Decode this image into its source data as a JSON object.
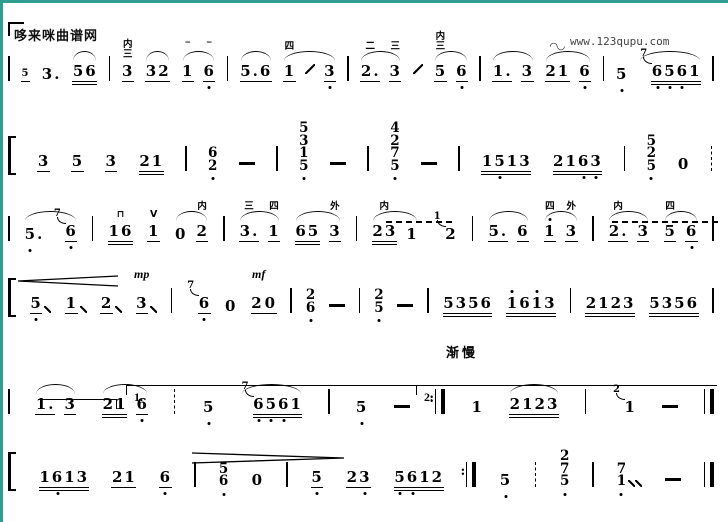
{
  "page": {
    "watermark": "哆来咪曲谱网",
    "site_url": "www.123qupu.com",
    "tempo_mark": "渐慢",
    "accent_color": "#2f9e92",
    "ink_color": "#000000"
  },
  "score": {
    "lines": [
      {
        "top": 30,
        "tokens": [
          {
            "t": "b",
            "v": "thin"
          },
          {
            "d": "5",
            "tiny": true,
            "u": 1
          },
          {
            "d": "3."
          },
          {
            "d": "56",
            "u": 2,
            "s": 1
          },
          {
            "t": "b",
            "v": "thin"
          },
          {
            "d": "3",
            "u": 1,
            "a": [
              "内",
              "三"
            ]
          },
          {
            "d": "32",
            "u": 1,
            "s": 1
          },
          {
            "t": "g",
            "s": 1,
            "n": [
              {
                "d": "1",
                "u": 1,
                "a": [
                  "‾"
                ]
              },
              {
                "d": "6",
                "u": 1,
                "lo": [
                  0
                ],
                "a": [
                  "‾"
                ]
              }
            ]
          },
          {
            "t": "b",
            "v": "thin"
          },
          {
            "d": "5.6",
            "u": 1,
            "s": 1
          },
          {
            "t": "g",
            "s": 1,
            "n": [
              {
                "d": "1",
                "u": 1,
                "a": [
                  "四"
                ]
              },
              {
                "t": "sl"
              },
              {
                "d": "3",
                "u": 1,
                "lo": [
                  0
                ]
              }
            ]
          },
          {
            "t": "b",
            "v": "thin"
          },
          {
            "t": "g",
            "s": 1,
            "n": [
              {
                "d": "2.",
                "u": 1,
                "a": [
                  "二"
                ]
              },
              {
                "d": "3",
                "u": 1,
                "a": [
                  "三"
                ]
              }
            ]
          },
          {
            "t": "sl"
          },
          {
            "t": "g",
            "s": 1,
            "n": [
              {
                "d": "5",
                "u": 1,
                "a": [
                  "内",
                  "三"
                ]
              },
              {
                "d": "6",
                "u": 1,
                "lo": [
                  0
                ]
              }
            ]
          },
          {
            "t": "b",
            "v": "thin"
          },
          {
            "t": "g",
            "s": 1,
            "n": [
              {
                "d": "1.",
                "u": 1
              },
              {
                "d": "3",
                "u": 1
              }
            ]
          },
          {
            "t": "g",
            "s": 1,
            "n": [
              {
                "d": "21",
                "u": 1,
                "a": [
                  "◠◡"
                ]
              },
              {
                "d": "6",
                "u": 1,
                "lo": [
                  0
                ]
              }
            ]
          },
          {
            "t": "b",
            "v": "thin"
          },
          {
            "d": "5",
            "lo": [
              0
            ]
          },
          {
            "d": "6561",
            "u": 2,
            "s": 1,
            "g": "7",
            "lo": [
              0,
              1,
              2
            ]
          },
          {
            "t": "b",
            "v": "thin"
          }
        ],
        "ex": []
      },
      {
        "top": 96,
        "tokens": [
          {
            "t": "b",
            "v": "brk"
          },
          {
            "d": "3",
            "u": 1
          },
          {
            "d": "5",
            "u": 1
          },
          {
            "d": "3",
            "u": 1
          },
          {
            "d": "21",
            "u": 2
          },
          {
            "t": "b",
            "v": "thin"
          },
          {
            "t": "c",
            "d": [
              "6",
              "2"
            ],
            "lo": true
          },
          {
            "t": "-"
          },
          {
            "t": "b",
            "v": "thin"
          },
          {
            "t": "c",
            "d": [
              "5",
              "3",
              "1",
              "5"
            ],
            "lo": true
          },
          {
            "t": "-"
          },
          {
            "t": "b",
            "v": "thin"
          },
          {
            "t": "c",
            "d": [
              "4",
              "2",
              "7",
              "5"
            ],
            "lo": true
          },
          {
            "t": "-"
          },
          {
            "t": "b",
            "v": "thin"
          },
          {
            "d": "1513",
            "u": 2,
            "lo": [
              1
            ]
          },
          {
            "d": "2163",
            "u": 2,
            "lo": [
              2,
              3
            ]
          },
          {
            "t": "b",
            "v": "thin"
          },
          {
            "t": "c",
            "d": [
              "5",
              "2",
              "5"
            ],
            "lo": true
          },
          {
            "d": "0"
          },
          {
            "t": "b",
            "v": "dash"
          }
        ],
        "ex": []
      },
      {
        "top": 190,
        "tokens": [
          {
            "t": "b",
            "v": "thin"
          },
          {
            "t": "g",
            "s": 1,
            "n": [
              {
                "d": "5.",
                "lo": [
                  0
                ]
              },
              {
                "d": "6",
                "u": 1,
                "lo": [
                  0
                ],
                "g": "7"
              }
            ]
          },
          {
            "t": "b",
            "v": "thin"
          },
          {
            "d": "16",
            "u": 2,
            "a": [
              "⊓"
            ]
          },
          {
            "d": "1",
            "u": 1,
            "a": [
              "V"
            ]
          },
          {
            "t": "g",
            "s": 1,
            "n": [
              {
                "d": "0"
              },
              {
                "d": "2",
                "u": 1,
                "a": [
                  "内"
                ]
              }
            ]
          },
          {
            "t": "b",
            "v": "thin"
          },
          {
            "t": "g",
            "s": 1,
            "n": [
              {
                "d": "3.",
                "u": 1,
                "a": [
                  "三"
                ]
              },
              {
                "d": "1",
                "u": 1,
                "a": [
                  "四"
                ]
              }
            ]
          },
          {
            "t": "g",
            "s": 1,
            "n": [
              {
                "d": "65",
                "u": 2
              },
              {
                "d": "3",
                "u": 1,
                "a": [
                  "外"
                ]
              }
            ]
          },
          {
            "t": "b",
            "v": "thin"
          },
          {
            "t": "g",
            "s": 1,
            "n": [
              {
                "d": "23",
                "u": 2,
                "a": [
                  "内"
                ]
              },
              {
                "d": "1"
              }
            ]
          },
          {
            "d": "2",
            "g": "1"
          },
          {
            "t": "b",
            "v": "thin"
          },
          {
            "t": "g",
            "s": 1,
            "n": [
              {
                "d": "5.",
                "u": 1
              },
              {
                "d": "6",
                "u": 1
              }
            ]
          },
          {
            "t": "g",
            "s": 1,
            "n": [
              {
                "d": "1",
                "u": 1,
                "hi": [
                  0
                ],
                "a": [
                  "四"
                ]
              },
              {
                "d": "3",
                "u": 1,
                "a": [
                  "外"
                ]
              }
            ]
          },
          {
            "t": "b",
            "v": "thin"
          },
          {
            "t": "g",
            "s": 1,
            "n": [
              {
                "d": "2.",
                "u": 1,
                "a": [
                  "内"
                ]
              },
              {
                "d": "3",
                "u": 1
              }
            ]
          },
          {
            "t": "g",
            "s": 1,
            "n": [
              {
                "d": "5",
                "u": 1,
                "a": [
                  "四"
                ]
              },
              {
                "d": "6",
                "u": 1,
                "lo": [
                  0
                ]
              }
            ]
          },
          {
            "t": "b",
            "v": "thin"
          }
        ],
        "ex": [
          {
            "t": "hairpin",
            "dir": "<",
            "x": 10,
            "w": 100,
            "y": 56
          },
          {
            "t": "dyn",
            "d": "mp",
            "x": 126,
            "y": 51
          },
          {
            "t": "dyn",
            "d": "mf",
            "x": 244,
            "y": 51
          },
          {
            "t": "dashline",
            "x": 378,
            "w": 66,
            "y": 5
          },
          {
            "t": "dashline",
            "x": 604,
            "w": 106,
            "y": 5
          }
        ]
      },
      {
        "top": 252,
        "tokens": [
          {
            "t": "b",
            "v": "brk"
          },
          {
            "d": "5",
            "u": 1,
            "lo": [
              0
            ],
            "post": "/"
          },
          {
            "d": "1",
            "u": 1,
            "post": "/"
          },
          {
            "d": "2",
            "u": 1,
            "post": "/"
          },
          {
            "d": "3",
            "u": 1,
            "post": "/"
          },
          {
            "t": "b",
            "v": "thin"
          },
          {
            "d": "6",
            "u": 1,
            "lo": [
              0
            ],
            "g": "7"
          },
          {
            "d": "0"
          },
          {
            "d": "2 0",
            "u": 1
          },
          {
            "t": "b",
            "v": "thin"
          },
          {
            "t": "c",
            "d": [
              "2",
              "6"
            ],
            "lo": true
          },
          {
            "t": "-"
          },
          {
            "t": "b",
            "v": "thin"
          },
          {
            "t": "c",
            "d": [
              "2",
              "5"
            ],
            "lo": true
          },
          {
            "t": "-"
          },
          {
            "t": "b",
            "v": "thin"
          },
          {
            "d": "5356",
            "u": 2
          },
          {
            "d": "1613",
            "u": 2,
            "hi": [
              0,
              2
            ]
          },
          {
            "t": "b",
            "v": "thin"
          },
          {
            "d": "2123",
            "u": 2
          },
          {
            "d": "5356",
            "u": 2
          },
          {
            "t": "b",
            "v": "thin"
          }
        ],
        "ex": []
      },
      {
        "top": 363,
        "tokens": [
          {
            "t": "b",
            "v": "thin"
          },
          {
            "t": "g",
            "s": 1,
            "n": [
              {
                "d": "1.",
                "u": 1
              },
              {
                "d": "3",
                "u": 1
              }
            ]
          },
          {
            "t": "g",
            "s": 1,
            "n": [
              {
                "d": "21",
                "u": 2
              },
              {
                "d": "6",
                "u": 1,
                "lo": [
                  0
                ]
              }
            ]
          },
          {
            "t": "b",
            "v": "dash"
          },
          {
            "d": "5",
            "lo": [
              0
            ]
          },
          {
            "d": "6561",
            "u": 2,
            "s": 1,
            "g": "7",
            "lo": [
              0,
              1,
              2
            ]
          },
          {
            "t": "b",
            "v": "thin"
          },
          {
            "d": "5",
            "lo": [
              0
            ]
          },
          {
            "t": "-"
          },
          {
            "t": "b",
            "v": "rep"
          },
          {
            "d": "1"
          },
          {
            "d": "2123",
            "u": 2,
            "s": 1
          },
          {
            "t": "b",
            "v": "thin"
          },
          {
            "d": "1",
            "g": "2"
          },
          {
            "t": "-"
          },
          {
            "t": "b",
            "v": "fin"
          }
        ],
        "ex": [
          {
            "t": "volta",
            "x": 30,
            "w": 78,
            "y": 10,
            "label": "",
            "tick": "right"
          },
          {
            "t": "volta",
            "x": 118,
            "w": 294,
            "y": -4,
            "label": "1.",
            "tick": "left"
          },
          {
            "t": "volta",
            "x": 408,
            "w": 300,
            "y": -4,
            "label": "2.",
            "tick": "left"
          },
          {
            "t": "hairpin",
            "dir": ">",
            "x": 184,
            "w": 152,
            "y": 60
          }
        ]
      },
      {
        "top": 424,
        "tokens": [
          {
            "t": "b",
            "v": "brk"
          },
          {
            "d": "1613",
            "u": 2,
            "lo": [
              1
            ]
          },
          {
            "d": "21",
            "u": 1
          },
          {
            "d": "6",
            "u": 1,
            "lo": [
              0
            ]
          },
          {
            "t": "b",
            "v": "thin"
          },
          {
            "t": "c",
            "d": [
              "5",
              "6"
            ],
            "lo": true
          },
          {
            "d": "0"
          },
          {
            "t": "b",
            "v": "thin"
          },
          {
            "d": "5",
            "u": 1,
            "lo": [
              0
            ]
          },
          {
            "d": "23",
            "u": 1,
            "lo": [
              1
            ]
          },
          {
            "d": "5612",
            "u": 2,
            "lo": [
              0,
              1
            ]
          },
          {
            "t": "b",
            "v": "rep"
          },
          {
            "d": "5",
            "lo": [
              0
            ]
          },
          {
            "t": "b",
            "v": "dash"
          },
          {
            "t": "c",
            "d": [
              "2",
              "7",
              "5"
            ],
            "lo": true
          },
          {
            "t": "b",
            "v": "thin"
          },
          {
            "t": "c",
            "d": [
              "7",
              "1"
            ],
            "lo": true,
            "post": "//"
          },
          {
            "t": "-"
          },
          {
            "t": "b",
            "v": "fin"
          }
        ],
        "ex": []
      }
    ]
  }
}
